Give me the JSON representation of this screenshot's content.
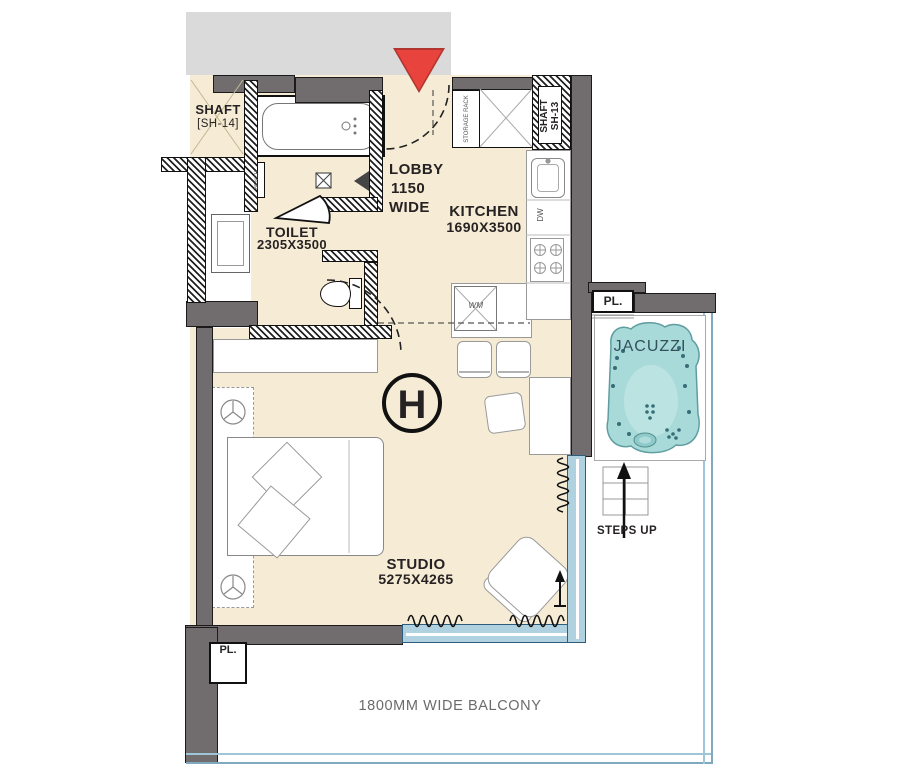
{
  "title": "Unit H Studio Floor Plan",
  "marker": {
    "unit_letter": "H"
  },
  "rooms": {
    "shaft14": {
      "name": "SHAFT",
      "code": "[SH-14]"
    },
    "toilet": {
      "name": "TOILET",
      "dims": "2305X3500"
    },
    "lobby": {
      "name": "LOBBY",
      "width_value": "1150",
      "width_word": "WIDE"
    },
    "kitchen": {
      "name": "KITCHEN",
      "dims": "1690X3500"
    },
    "studio": {
      "name": "STUDIO",
      "dims": "5275X4265"
    },
    "balcony": {
      "label": "1800MM WIDE BALCONY"
    },
    "shaft13": {
      "line1": "SHAFT",
      "line2": "SH-13"
    }
  },
  "fixtures": {
    "jacuzzi_label": "JACUZZI",
    "steps_label": "STEPS UP",
    "planter_label": "PL.",
    "storage_rack_label": "STORAGE RACK",
    "dishwasher_label": "DW",
    "washer_label": "WM",
    "bench_label": "BENCH"
  },
  "colors": {
    "floor": "#f6ecd5",
    "wall": "#716d6e",
    "corridor": "#dadada",
    "entry_marker": "#e8433c",
    "jacuzzi": "#a8dad9",
    "glass": "#b0d2e0",
    "railing": "#9fc6d8"
  }
}
